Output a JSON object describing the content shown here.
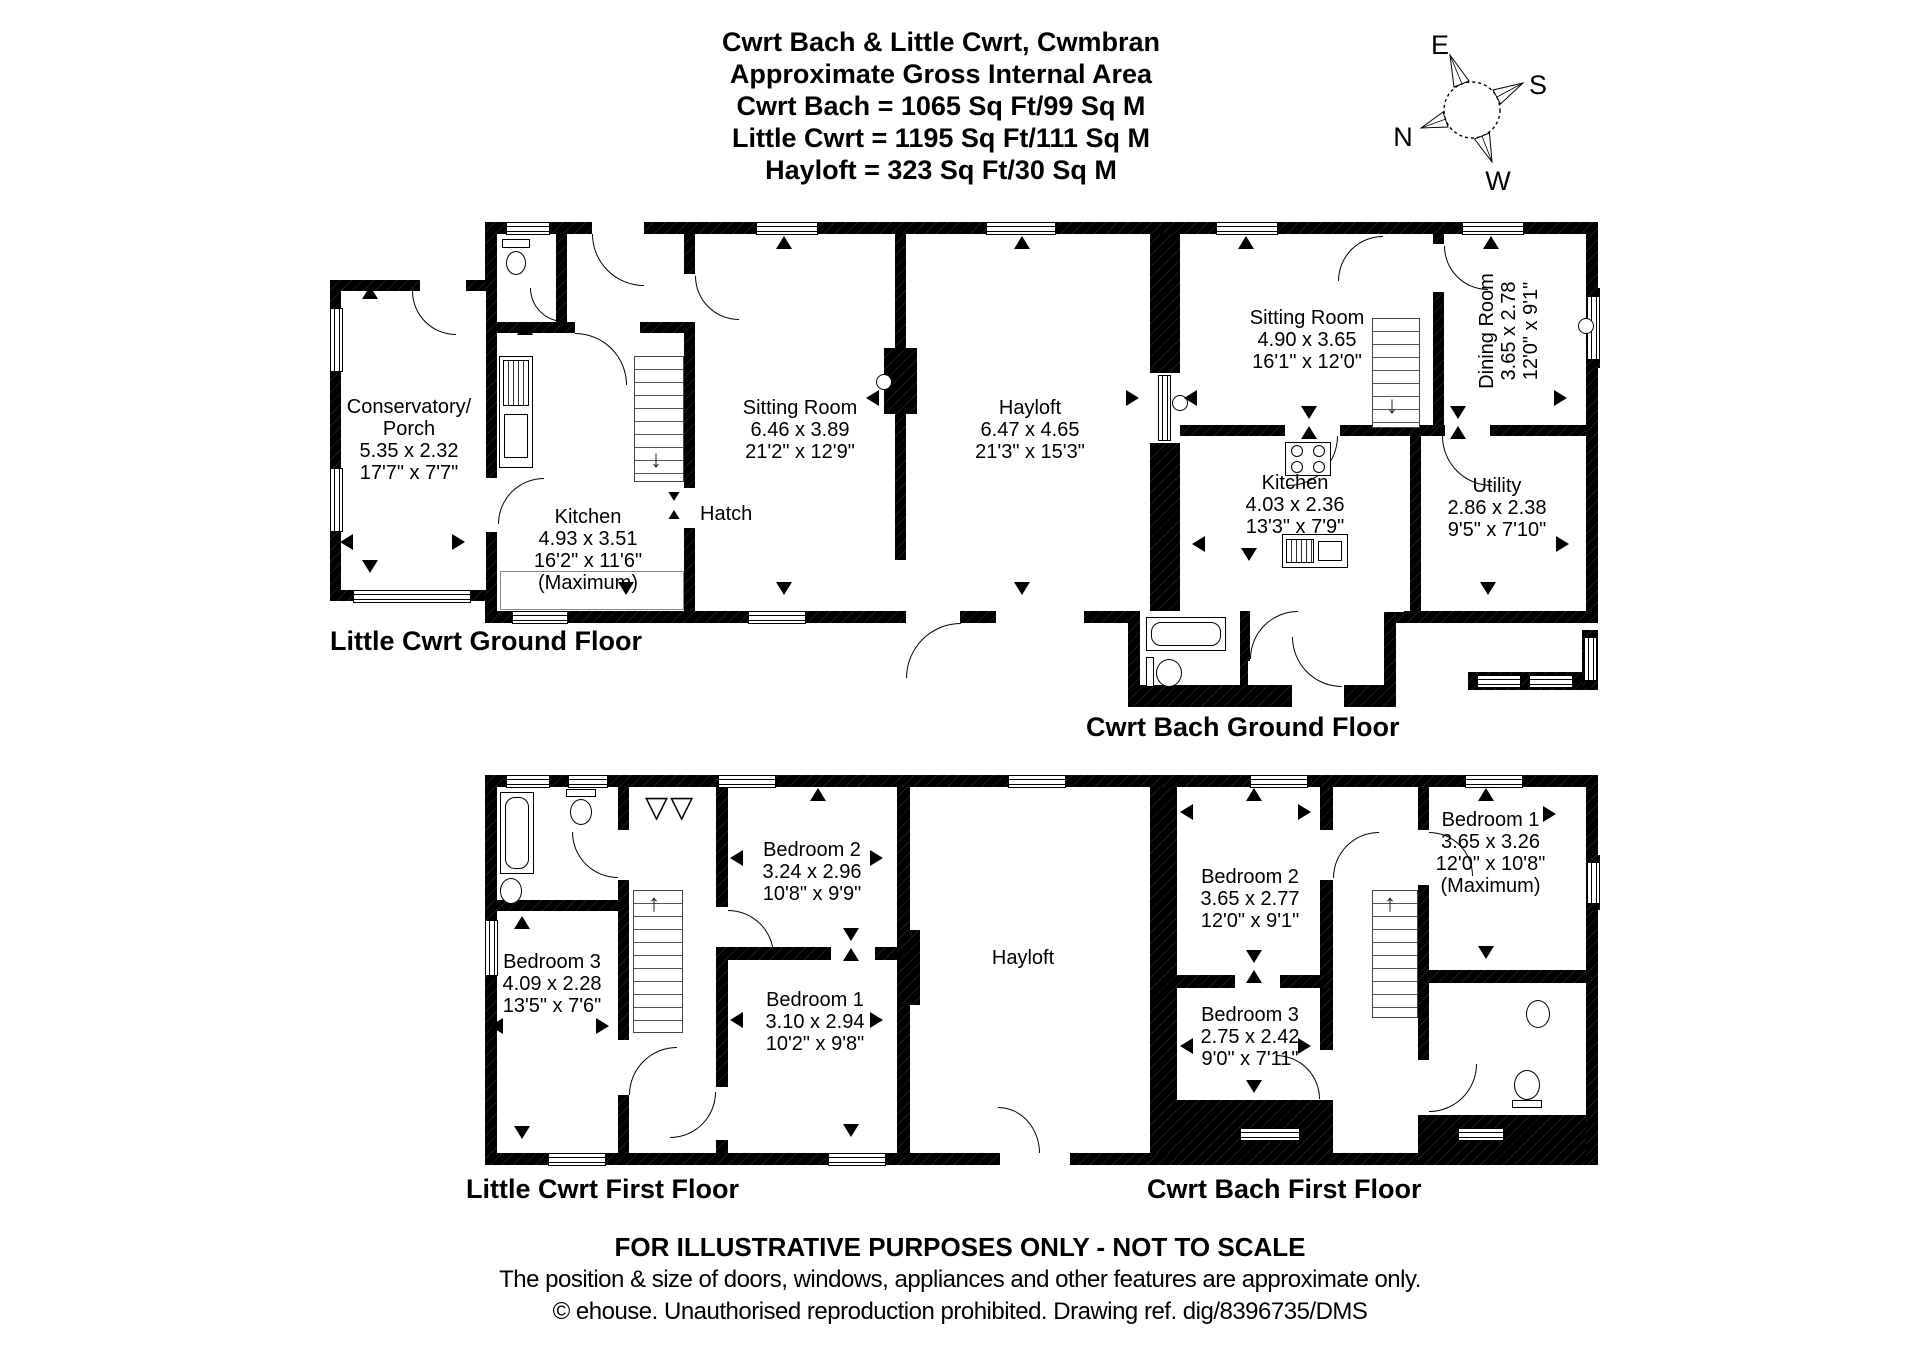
{
  "title": {
    "line1": "Cwrt Bach & Little Cwrt, Cwmbran",
    "line2": "Approximate Gross Internal Area",
    "line3": "Cwrt Bach = 1065 Sq Ft/99 Sq M",
    "line4": "Little Cwrt = 1195 Sq Ft/111 Sq M",
    "line5": "Hayloft = 323 Sq Ft/30 Sq M"
  },
  "compass": {
    "e": "E",
    "s": "S",
    "n": "N",
    "w": "W"
  },
  "floors": {
    "lcg": {
      "caption": "Little Cwrt Ground Floor",
      "rooms": {
        "conservatory": {
          "name": "Conservatory/",
          "name2": "Porch",
          "metric": "5.35 x 2.32",
          "imperial": "17'7\" x 7'7\""
        },
        "kitchen": {
          "name": "Kitchen",
          "metric": "4.93 x 3.51",
          "imperial": "16'2\" x 11'6\"",
          "note": "(Maximum)"
        },
        "sitting": {
          "name": "Sitting Room",
          "metric": "6.46 x 3.89",
          "imperial": "21'2\" x 12'9\""
        },
        "hayloft": {
          "name": "Hayloft",
          "metric": "6.47 x 4.65",
          "imperial": "21'3\" x 15'3\""
        },
        "hatch": {
          "name": "Hatch"
        }
      }
    },
    "cbg": {
      "caption": "Cwrt Bach Ground Floor",
      "rooms": {
        "sitting": {
          "name": "Sitting Room",
          "metric": "4.90 x 3.65",
          "imperial": "16'1\" x 12'0\""
        },
        "dining": {
          "name": "Dining Room",
          "metric": "3.65 x 2.78",
          "imperial": "12'0\" x 9'1\""
        },
        "kitchen": {
          "name": "Kitchen",
          "metric": "4.03 x 2.36",
          "imperial": "13'3\" x 7'9\""
        },
        "utility": {
          "name": "Utility",
          "metric": "2.86 x 2.38",
          "imperial": "9'5\" x 7'10\""
        }
      }
    },
    "lcf": {
      "caption": "Little Cwrt First Floor",
      "rooms": {
        "bedroom2": {
          "name": "Bedroom 2",
          "metric": "3.24 x 2.96",
          "imperial": "10'8\" x 9'9\""
        },
        "bedroom1": {
          "name": "Bedroom 1",
          "metric": "3.10 x 2.94",
          "imperial": "10'2\" x 9'8\""
        },
        "bedroom3": {
          "name": "Bedroom 3",
          "metric": "4.09 x 2.28",
          "imperial": "13'5\" x 7'6\""
        },
        "hayloft": {
          "name": "Hayloft"
        }
      }
    },
    "cbf": {
      "caption": "Cwrt Bach First Floor",
      "rooms": {
        "bedroom1": {
          "name": "Bedroom 1",
          "metric": "3.65 x 3.26",
          "imperial": "12'0\" x 10'8\"",
          "note": "(Maximum)"
        },
        "bedroom2": {
          "name": "Bedroom 2",
          "metric": "3.65 x 2.77",
          "imperial": "12'0\" x 9'1\""
        },
        "bedroom3": {
          "name": "Bedroom 3",
          "metric": "2.75 x 2.42",
          "imperial": "9'0\" x 7'11\""
        }
      }
    }
  },
  "footer": {
    "line1": "FOR ILLUSTRATIVE PURPOSES ONLY - NOT TO SCALE",
    "line2": "The position & size of doors, windows, appliances and other features are approximate only.",
    "line3": "© ehouse. Unauthorised reproduction prohibited. Drawing ref. dig/8396735/DMS"
  },
  "colors": {
    "wall": "#000000",
    "bg": "#ffffff",
    "text": "#000000"
  }
}
